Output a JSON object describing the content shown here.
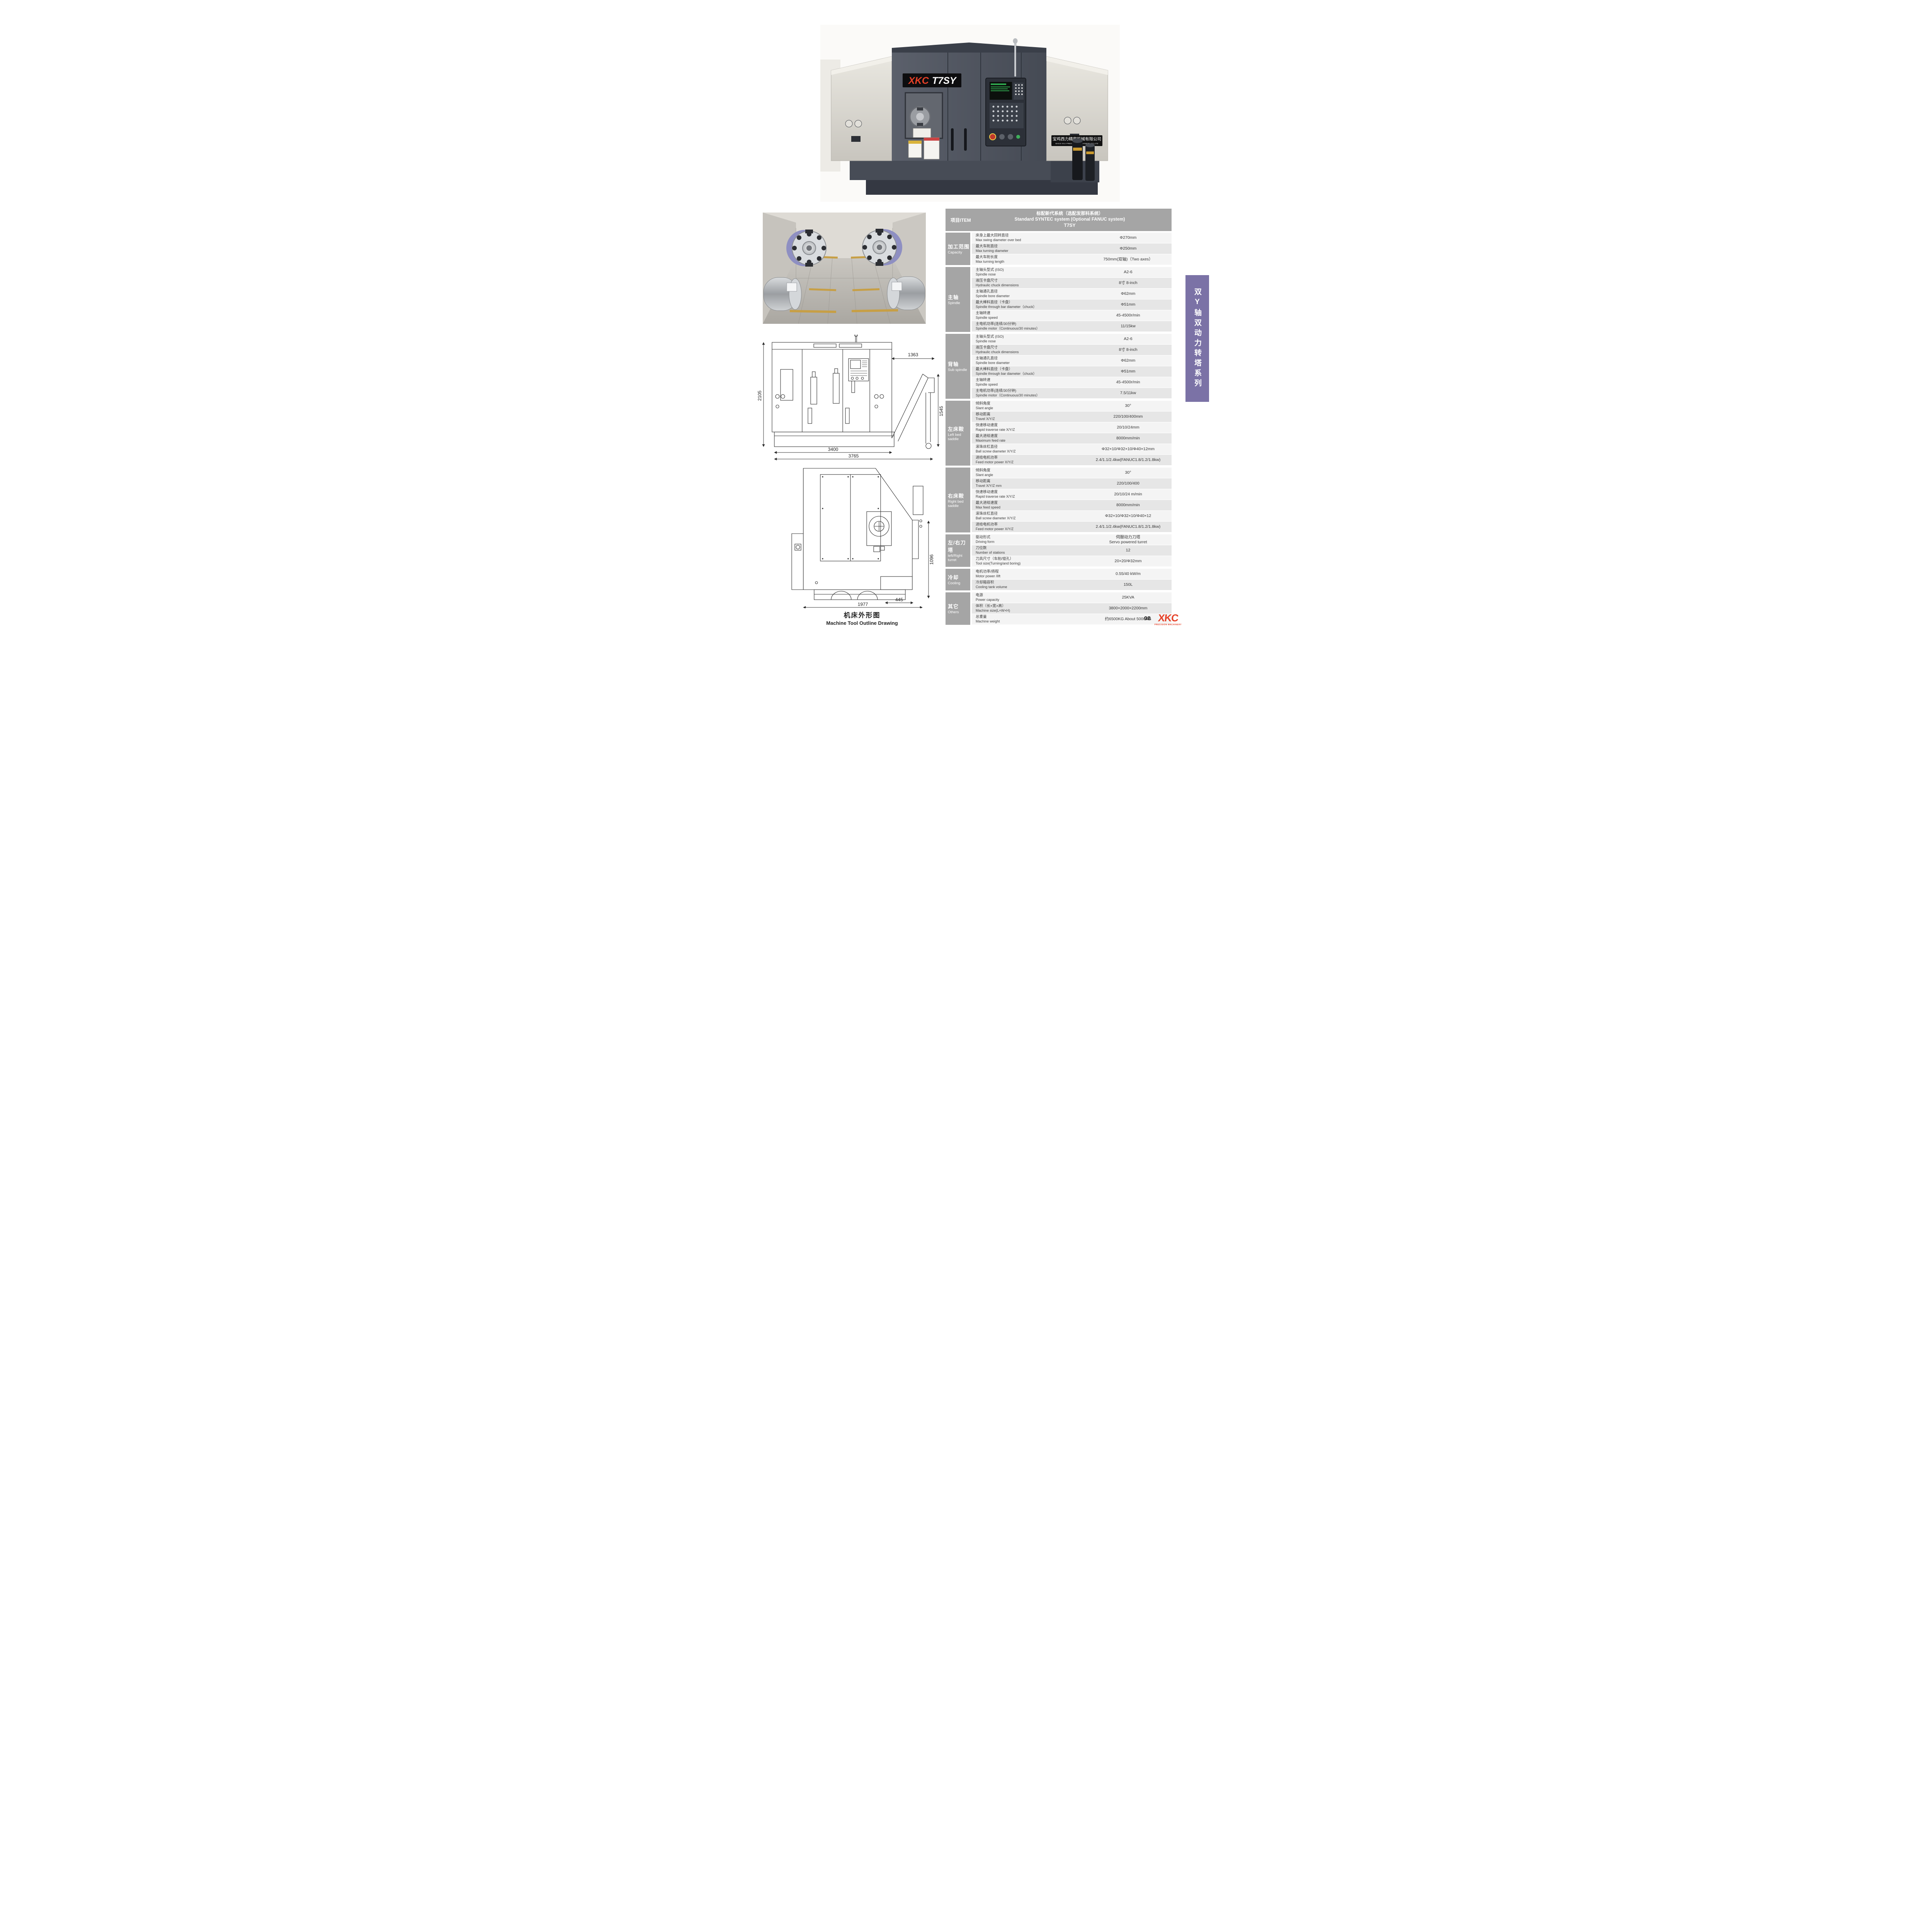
{
  "colors": {
    "accent_red": "#e64128",
    "banner_purple": "#7b72a6",
    "table_gray": "#a5a5a5",
    "row_light": "#f4f4f4",
    "row_dark": "#e6e6e6",
    "machine_dark": "#474c56",
    "machine_light_panel": "#dcd9d2"
  },
  "machine_photo": {
    "nameplate_brand": "XKC",
    "nameplate_model": "T7SY",
    "company_plate_cn": "宝鸡西力精密机械有限公司",
    "company_plate_en": "BAOJI XILI PRECISION MACHINERY CO.LTD"
  },
  "side_banner": {
    "text": "双Y轴双动力转塔系列"
  },
  "outline_drawings": {
    "caption_cn": "机床外形图",
    "caption_en": "Machine Tool Outline Drawing",
    "front_view": {
      "height_overall": "2105",
      "conveyor_width": "1363",
      "conveyor_height": "1545",
      "body_width": "3400",
      "overall_width": "3765"
    },
    "side_view": {
      "height": "1096",
      "tank_width": "445",
      "depth": "1977"
    }
  },
  "footer": {
    "page_number": "08",
    "logo_text": "XKC",
    "logo_sub": "PRECISION MACHINERY"
  },
  "spec_table": {
    "header": {
      "item_label": "项目ITEM",
      "system_line1": "标配新代系统（选配发那科系统）",
      "system_line2": "Standard SYNTEC system (Optional FANUC system)",
      "system_line3": "T7SY"
    },
    "sections": [
      {
        "label_cn": "加工范围",
        "label_en": "Capacity",
        "rows": [
          {
            "cn": "床身上最大回转直径",
            "en": "Max swing diameter over bed",
            "value": "Φ270mm"
          },
          {
            "cn": "最大车削直径",
            "en": "Max turning diameter",
            "value": "Φ250mm"
          },
          {
            "cn": "最大车削长度",
            "en": "Max turning length",
            "value": "750mm(双轴)（Two axes）"
          }
        ]
      },
      {
        "label_cn": "主轴",
        "label_en": "Spindle",
        "rows": [
          {
            "cn": "主轴头型式 (ISO)",
            "en": "Spindle nose",
            "value": "A2-6"
          },
          {
            "cn": "液压卡盘尺寸",
            "en": "Hydraulic chuck dimensions",
            "value": "8寸  8-inch"
          },
          {
            "cn": "主轴通孔直径",
            "en": "Spindle bore diameter",
            "value": "Φ62mm"
          },
          {
            "cn": "最大棒料直径（卡盘）",
            "en": "Spindle through bar diameter（chuck）",
            "value": "Φ51mm"
          },
          {
            "cn": "主轴转速",
            "en": "Spindle speed",
            "value": "45-4500r/min"
          },
          {
            "cn": "主电机功率(连续/30分钟)",
            "en": "Spindle motor（Continuous/30 minutes）",
            "value": "11/15kw"
          }
        ]
      },
      {
        "label_cn": "背轴",
        "label_en": "Sub spindle",
        "rows": [
          {
            "cn": "主轴头型式 (ISO)",
            "en": "Spindle nose",
            "value": "A2-6"
          },
          {
            "cn": "液压卡盘尺寸",
            "en": "Hydraulic chuck dimensions",
            "value": "8寸  8-inch"
          },
          {
            "cn": "主轴通孔直径",
            "en": "Spindle bore diameter",
            "value": "Φ62mm"
          },
          {
            "cn": "最大棒料直径（卡盘）",
            "en": "Spindle through bar diameter（chuck）",
            "value": "Φ51mm"
          },
          {
            "cn": "主轴转速",
            "en": "Spindle speed",
            "value": "45-4500r/min"
          },
          {
            "cn": "主电机功率(连续/30分钟)",
            "en": "Spindle motor（Continuous/30 minutes）",
            "value": "7.5/11kw"
          }
        ]
      },
      {
        "label_cn": "左床鞍",
        "label_en": "Left bed saddle",
        "rows": [
          {
            "cn": "倾斜角度",
            "en": "Slant angle",
            "value": "30°"
          },
          {
            "cn": "移动距离",
            "en": "Travel X/Y/Z",
            "value": "220/100/400mm"
          },
          {
            "cn": "快速移动速度",
            "en": "Rapid traverse rate X/Y/Z",
            "value": "20/10/24mm"
          },
          {
            "cn": "最大进给速度",
            "en": "Maximum feed rate",
            "value": "8000mm/min"
          },
          {
            "cn": "滚珠丝杠直径",
            "en": "Ball screw diameter X/Y/Z",
            "value": "Φ32×10/Φ32×10/Φ40×12mm"
          },
          {
            "cn": "进给电机功率",
            "en": "Feed motor power  X/Y/Z",
            "value": "2.4/1.1/2.4kw(FANUC1.8/1.2/1.8kw)"
          }
        ]
      },
      {
        "label_cn": "右床鞍",
        "label_en": "Right bed saddle",
        "rows": [
          {
            "cn": "倾斜角度",
            "en": "Slant angle",
            "value": "30°"
          },
          {
            "cn": "移动距离",
            "en": "Travel  X/Y/Z mm",
            "value": "220/100/400"
          },
          {
            "cn": "快速移动速度",
            "en": "Rapid traverse rate X/Y/Z",
            "value": "20/10/24 m/min"
          },
          {
            "cn": "最大进给速度",
            "en": "Max feed speed",
            "value": "8000mm/min"
          },
          {
            "cn": "滚珠丝杠直径",
            "en": "Ball screw diameter X/Y/Z",
            "value": "Φ32×10/Φ32×10/Φ40×12"
          },
          {
            "cn": "进给电机功率",
            "en": "Feed motor power X/Y/Z",
            "value": "2.4/1.1/2.4kw(FANUC1.8/1.2/1.8kw)"
          }
        ]
      },
      {
        "label_cn": "左/右刀塔",
        "label_en": "left/Right turret",
        "rows": [
          {
            "cn": "驱动形式",
            "en": "Driving form",
            "value": "伺服动力刀塔",
            "value2": "Servo powered turret"
          },
          {
            "cn": "刀位数",
            "en": "Number of stations",
            "value": "12"
          },
          {
            "cn": "刀具尺寸（车削/镗孔）",
            "en": "Tool size(Turning/and boring)",
            "value": "20×20/Φ32mm"
          }
        ]
      },
      {
        "label_cn": "冷却",
        "label_en": "Cooling",
        "rows": [
          {
            "cn": "电机功率/扬程",
            "en": "Motor power /lift",
            "value": "0.55/40 kW/m"
          },
          {
            "cn": "冷却箱容积",
            "en": "Cooling tank  volume",
            "value": "150L"
          }
        ]
      },
      {
        "label_cn": "其它",
        "label_en": "Others",
        "rows": [
          {
            "cn": "电源",
            "en": "Power capacity",
            "value": "25KVA"
          },
          {
            "cn": "体积（长×宽×高）",
            "en": "Machine size(L×W×H)",
            "value": "3800×2000×2200mm"
          },
          {
            "cn": "总重量",
            "en": "Machine weight",
            "value": "约6500KG  About 5000KG"
          }
        ]
      }
    ]
  }
}
